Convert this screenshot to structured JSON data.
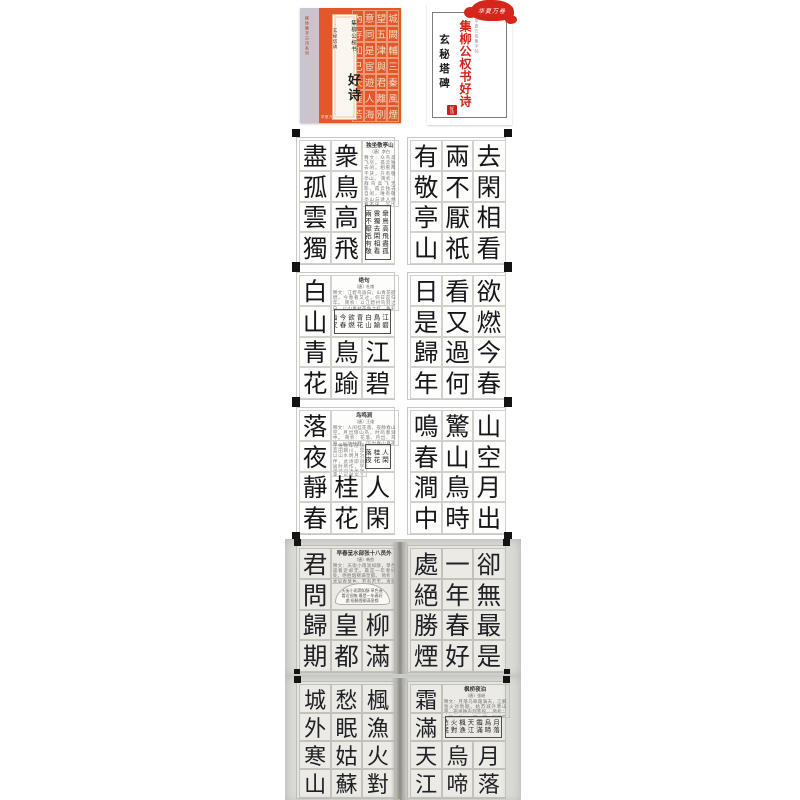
{
  "covers": {
    "front": {
      "spine_text": "柳体集字古诗系列",
      "title_small": "集柳公权书",
      "title_large": "好诗",
      "subtitle": "·玄秘塔碑",
      "publisher_small": "华夏万卷",
      "grid_chars": "城闕輔三秦風煙望五津與君離別意同是宦遊人海內存知己天涯若比鄰",
      "colors": {
        "orange": "#e2582a",
        "strip": "#c9c4ce",
        "label_bg": "#fbf7ee"
      }
    },
    "title_page": {
      "logo_text": "华夏万卷",
      "series_small": "华夏万卷集字帖",
      "title_red": "集柳公权书好诗",
      "title_black": "玄秘塔碑",
      "seal_text": "好诗",
      "colors": {
        "red": "#cf231b",
        "seal": "#c4241b"
      }
    }
  },
  "spreads": [
    {
      "photo": false,
      "left": {
        "cells": [
          {
            "t": "col",
            "c": 0,
            "chars": "盡孤雲獨"
          },
          {
            "t": "col",
            "c": 1,
            "chars": "衆鳥高飛"
          },
          {
            "t": "note",
            "c": 2,
            "r": 0,
            "w": 1,
            "h": 2,
            "title": "独坐敬亭山",
            "author": "〔唐〕李白",
            "body": "释文：众鸟高飞尽，孤云独去闲。相看两不厌，只有敬亭山。 简析：群鸟高飞无影，孤云独去自闲，唯有敬亭山与诗人相看不厌，写出超然物外的闲适心境。"
          },
          {
            "t": "frame",
            "c": 2,
            "r": 2,
            "w": 1,
            "h": 2,
            "text": "衆鳥高飛盡孤雲獨去閑相看兩不厭祇有敬亭山"
          }
        ]
      },
      "right": {
        "cells": [
          {
            "t": "col",
            "c": 0,
            "chars": "有敬亭山"
          },
          {
            "t": "col",
            "c": 1,
            "chars": "兩不厭祇"
          },
          {
            "t": "col",
            "c": 2,
            "chars": "去閑相看"
          }
        ]
      }
    },
    {
      "photo": false,
      "left": {
        "cells": [
          {
            "t": "col",
            "c": 0,
            "chars": "白山青花"
          },
          {
            "t": "note",
            "c": 1,
            "r": 0,
            "w": 2,
            "h": 1,
            "title": "绝句",
            "author": "〔唐〕杜甫",
            "body": "释文：江碧鸟逾白，山青花欲燃。今春看又过，何日是归年。 简析：以江碧衬鸟羽之白，以山青衬花色之红，色彩明丽，反衬出诗人思归的感伤。"
          },
          {
            "t": "frame",
            "c": 1,
            "r": 1,
            "w": 2,
            "h": 1,
            "text": "江碧鳥踰白山青花欲燃今春看又過何日是歸年"
          },
          {
            "t": "char",
            "c": 1,
            "r": 2,
            "ch": "鳥"
          },
          {
            "t": "char",
            "c": 1,
            "r": 3,
            "ch": "踰"
          },
          {
            "t": "char",
            "c": 2,
            "r": 2,
            "ch": "江"
          },
          {
            "t": "char",
            "c": 2,
            "r": 3,
            "ch": "碧"
          }
        ]
      },
      "right": {
        "cells": [
          {
            "t": "col",
            "c": 0,
            "chars": "日是歸年"
          },
          {
            "t": "col",
            "c": 1,
            "chars": "看又過何"
          },
          {
            "t": "col",
            "c": 2,
            "chars": "欲燃今春"
          }
        ]
      }
    },
    {
      "photo": false,
      "left": {
        "cells": [
          {
            "t": "col",
            "c": 0,
            "chars": "落夜靜春"
          },
          {
            "t": "note",
            "c": 1,
            "r": 0,
            "w": 2,
            "h": 1,
            "title": "鸟鸣涧",
            "author": "〔唐〕王维",
            "body": "释文：人闲桂花落，夜静春山空。月出惊山鸟，时鸣春涧中。 简析：花落、月出、鸟鸣，以动衬静，写出春山月夜幽美空灵的境界。"
          },
          {
            "t": "note",
            "c": 1,
            "r": 1,
            "w": 1,
            "h": 1,
            "body": "王维晚年隐居蓝田辋川，常以山水明月为伴，此诗即闲居时所作，字里行间透出禅意，历来为人传诵。"
          },
          {
            "t": "frame",
            "c": 2,
            "r": 1,
            "w": 1,
            "h": 1,
            "text": "人閑桂花落夜靜春山空月出驚山鳥時鳴春澗中"
          },
          {
            "t": "char",
            "c": 1,
            "r": 2,
            "ch": "桂"
          },
          {
            "t": "char",
            "c": 1,
            "r": 3,
            "ch": "花"
          },
          {
            "t": "char",
            "c": 2,
            "r": 2,
            "ch": "人"
          },
          {
            "t": "char",
            "c": 2,
            "r": 3,
            "ch": "閑"
          }
        ]
      },
      "right": {
        "cells": [
          {
            "t": "col",
            "c": 0,
            "chars": "鳴春澗中"
          },
          {
            "t": "col",
            "c": 1,
            "chars": "驚山鳥時"
          },
          {
            "t": "col",
            "c": 2,
            "chars": "山空月出"
          }
        ]
      }
    },
    {
      "photo": true,
      "left": {
        "cells": [
          {
            "t": "col",
            "c": 0,
            "chars": "君問歸期"
          },
          {
            "t": "note",
            "c": 1,
            "r": 0,
            "w": 2,
            "h": 1,
            "title": "早春呈水部张十八员外",
            "author": "〔唐〕韩愈",
            "body": "释文：天街小雨润如酥，草色遥看近却无。最是一年春好处，绝胜烟柳满皇都。 简析：状早春草色，若有若无，清新传神。"
          },
          {
            "t": "fan",
            "c": 1,
            "r": 1,
            "w": 2,
            "h": 1,
            "text": "天街小雨潤如酥 草色遙看近卻無 最是一年春好處 絕勝煙柳滿皇都"
          },
          {
            "t": "char",
            "c": 1,
            "r": 2,
            "ch": "皇"
          },
          {
            "t": "char",
            "c": 1,
            "r": 3,
            "ch": "都"
          },
          {
            "t": "char",
            "c": 2,
            "r": 2,
            "ch": "柳"
          },
          {
            "t": "char",
            "c": 2,
            "r": 3,
            "ch": "滿"
          }
        ]
      },
      "right": {
        "cells": [
          {
            "t": "col",
            "c": 0,
            "chars": "處絕勝煙"
          },
          {
            "t": "col",
            "c": 1,
            "chars": "一年春好"
          },
          {
            "t": "col",
            "c": 2,
            "chars": "卻無最是"
          }
        ]
      }
    },
    {
      "photo": true,
      "left": {
        "cells": [
          {
            "t": "col",
            "c": 0,
            "chars": "城外寒山"
          },
          {
            "t": "col",
            "c": 1,
            "chars": "愁眠姑蘇"
          },
          {
            "t": "col",
            "c": 2,
            "chars": "楓漁火對"
          }
        ]
      },
      "right": {
        "cells": [
          {
            "t": "col",
            "c": 0,
            "chars": "霜滿天江"
          },
          {
            "t": "note",
            "c": 1,
            "r": 0,
            "w": 2,
            "h": 1,
            "title": "枫桥夜泊",
            "author": "〔唐〕张继",
            "body": "释文：月落乌啼霜满天，江枫渔火对愁眠。姑苏城外寒山寺，夜半钟声到客船。 简析：一静一动、一明一暗，写尽羁旅愁思。"
          },
          {
            "t": "frame",
            "c": 1,
            "r": 1,
            "w": 2,
            "h": 1,
            "text": "月落烏啼霜滿天江楓漁火對愁眠姑蘇城外寒山寺夜半鐘聲到客船"
          },
          {
            "t": "char",
            "c": 1,
            "r": 2,
            "ch": "烏"
          },
          {
            "t": "char",
            "c": 1,
            "r": 3,
            "ch": "啼"
          },
          {
            "t": "char",
            "c": 2,
            "r": 2,
            "ch": "月"
          },
          {
            "t": "char",
            "c": 2,
            "r": 3,
            "ch": "落"
          }
        ]
      }
    }
  ]
}
